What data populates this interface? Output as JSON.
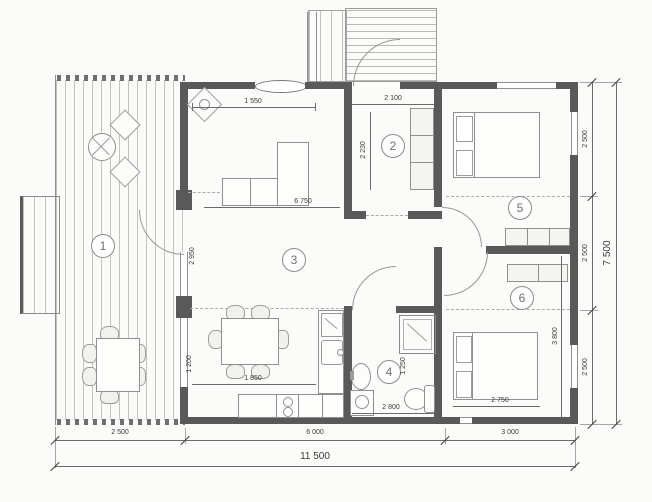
{
  "plan": {
    "type": "architectural-floor-plan",
    "rooms": {
      "r1": "1",
      "r2": "2",
      "r3": "3",
      "r4": "4",
      "r5": "5",
      "r6": "6"
    },
    "dims": {
      "bottom_left": "2 500",
      "bottom_mid": "6 000",
      "bottom_right": "3 000",
      "bottom_total": "11 500",
      "right_top": "2 500",
      "right_mid": "2 500",
      "right_bottom": "2 500",
      "right_total": "7 500",
      "living_top": "1 550",
      "hall_top": "2 100",
      "hall_left": "2 230",
      "living_left": "2 950",
      "living_mid": "6 750",
      "kitchen_w": "1 850",
      "kitchen_h": "1 200",
      "bath_w": "2 800",
      "bath_h": "1 250",
      "bed6_w": "2 750",
      "bed6_h": "3 800"
    },
    "colors": {
      "wall": "#595959",
      "line": "#9a9a9a",
      "dim_text": "#3a3a3a"
    }
  }
}
